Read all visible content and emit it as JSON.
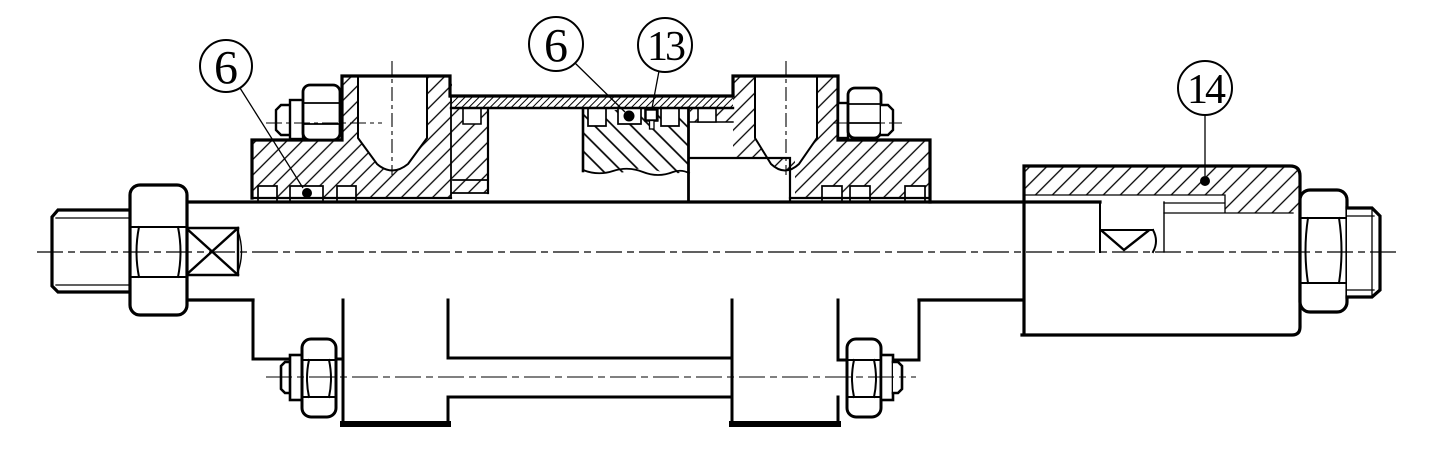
{
  "drawing": {
    "type": "engineering-section-drawing",
    "background": "#ffffff",
    "line_color": "#000000",
    "callouts": [
      {
        "label": "6",
        "cx": 226,
        "cy": 66,
        "r": 26,
        "leader": [
          240,
          88,
          303,
          188
        ],
        "dot": null
      },
      {
        "label": "6",
        "cx": 556,
        "cy": 44,
        "r": 27,
        "leader": [
          575,
          63,
          625,
          112
        ],
        "dot": null
      },
      {
        "label": "13",
        "cx": 665,
        "cy": 45,
        "r": 27,
        "leader": [
          659,
          71,
          652,
          108
        ],
        "dot": null
      },
      {
        "label": "14",
        "cx": 1205,
        "cy": 88,
        "r": 27,
        "leader": [
          1205,
          115,
          1205,
          176
        ],
        "dot": [
          1205,
          181
        ]
      }
    ]
  }
}
